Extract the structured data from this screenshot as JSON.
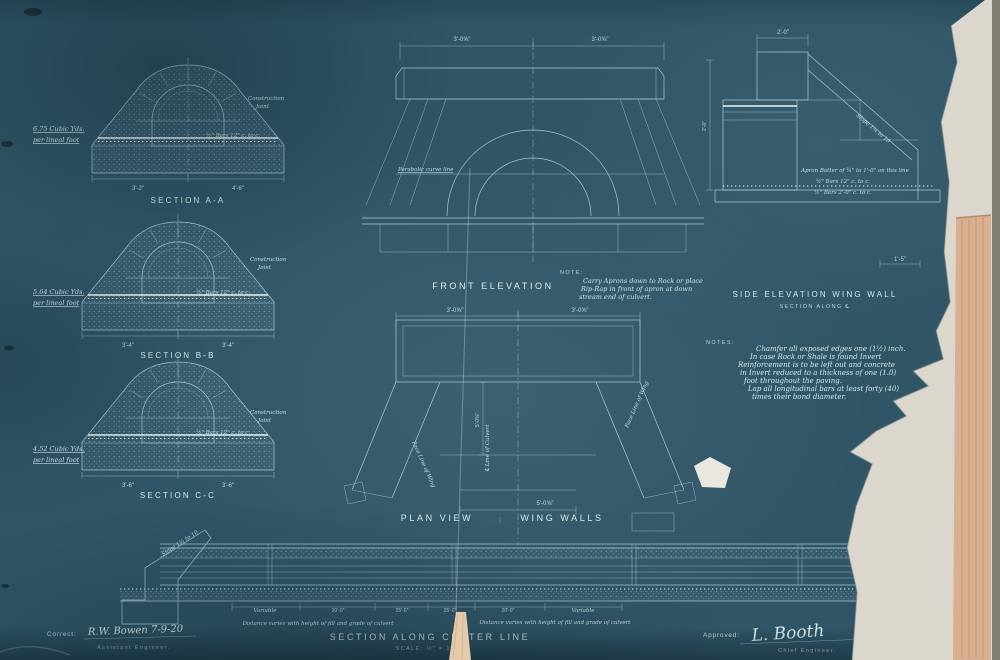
{
  "sheet": {
    "kind": "concrete arch culvert blueprint"
  },
  "sections": {
    "a": {
      "quantity_line1": "6.75 Cubic Yds.",
      "quantity_line2": "per lineal foot",
      "title": "SECTION A-A",
      "dim_bottom_left": "3'-2\"",
      "dim_bottom_right": "4'-6\"",
      "rebar_note": "½\" Bars 12\" c. to c.",
      "joint1": "Construction",
      "joint2": "Joint"
    },
    "b": {
      "quantity_line1": "5.64 Cubic Yds.",
      "quantity_line2": "per lineal foot",
      "title": "SECTION B-B",
      "dim_bottom_left": "3'-4\"",
      "dim_bottom_right": "3'-4\"",
      "rebar_note": "½\" Bars 12\" c. to c.",
      "joint1": "Construction",
      "joint2": "Joint"
    },
    "c": {
      "quantity_line1": "4.52 Cubic Yds.",
      "quantity_line2": "per lineal foot",
      "title": "SECTION C-C",
      "dim_bottom_left": "3'-6\"",
      "dim_bottom_right": "3'-6\"",
      "rebar_note": "½\" Bars 12\" c. to c.",
      "joint1": "Construction",
      "joint2": "Joint"
    }
  },
  "front": {
    "dim_top_left": "3'-0⅝\"",
    "dim_top_right": "3'-0⅝\"",
    "curve_label": "Parabolic curve line",
    "title": "FRONT ELEVATION",
    "note_label": "NOTE:",
    "note_line1": "Carry Aprons down to Rock or place",
    "note_line2": "Rip-Rap in front of apron at down",
    "note_line3": "stream end of culvert."
  },
  "side": {
    "dim_top": "2'-0\"",
    "slope_label": "Slope 1¼ to 10",
    "batter_label": "Apron Batter of ¾\" to 1'-0\" on this line",
    "rebar1": "½\" Bars 12\" c. to c.",
    "rebar2": "½\" Bars 2'-0\" c. to c.",
    "dim_left": "2'-0\"",
    "dim_bottom": "1'-5\"",
    "title": "SIDE ELEVATION WING WALL",
    "subtitle": "SECTION ALONG ℄"
  },
  "notes": {
    "label": "NOTES:",
    "line1": "Chamfer all exposed edges one (1½) inch.",
    "line2": "In case Rock or Shale is found Invert",
    "line3": "Reinforcement is to be left out and concrete",
    "line4": "in Invert reduced to a thickness of one (1.0)",
    "line5": "foot throughout the paving.",
    "line6": "Lap all longitudinal bars at least forty (40)",
    "line7": "times their bond diameter."
  },
  "plan": {
    "dim_top_left": "3'-0⅝\"",
    "dim_top_right": "3'-0⅝\"",
    "dim_mid": "5'-0⅝\"",
    "dim_bottom": "5'-0⅝\"",
    "center_line_label": "℄ Line of Culvert",
    "wing_left_label": "Face Line of Wing",
    "wing_right_label": "Face Line of Wing",
    "title_left": "PLAN VIEW",
    "title_right": "WING WALLS"
  },
  "bottom_section": {
    "slope_label": "Slope 1¼ to 10",
    "dim1": "Variable",
    "dim2": "20'-0\"",
    "dim3": "25'-0\"",
    "dim4": "25'-0\"",
    "dim5": "20'-0\"",
    "dim6": "Variable",
    "note_left": "Distance varies with height of fill and grade of culvert",
    "note_right": "Distance varies with height of fill and grade of culvert",
    "title": "SECTION ALONG CENTER LINE",
    "scale": "SCALE: ½\" = 1'-0\""
  },
  "signoff": {
    "correct_label": "Correct:",
    "correct_signature": "R.W. Bowen  7-9-20",
    "correct_title": "Assistant Engineer.",
    "approved_label": "Approved:",
    "approved_signature": "L. Booth",
    "approved_title": "Chief Engineer."
  },
  "colors": {
    "paper": "#2f5567",
    "line": "#a9c7d3",
    "bright": "#e9f4f2",
    "backing": "#dbd7cc",
    "tape": "#d8af8f"
  }
}
